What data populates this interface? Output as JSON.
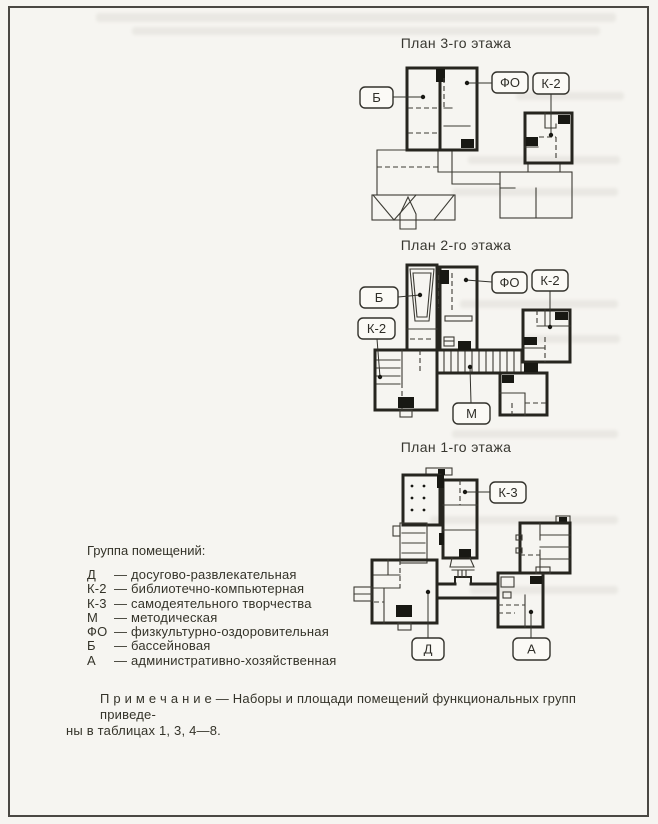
{
  "document": {
    "plans": [
      {
        "title": "План 3-го этажа",
        "callouts": {
          "b": "Б",
          "fo": "ФО",
          "k2": "К-2"
        }
      },
      {
        "title": "План 2-го этажа",
        "callouts": {
          "b": "Б",
          "k2_left": "К-2",
          "fo": "ФО",
          "k2_right": "К-2",
          "m": "М"
        }
      },
      {
        "title": "План 1-го этажа",
        "callouts": {
          "k3": "К-3",
          "d": "Д",
          "a": "А"
        }
      }
    ],
    "legend": {
      "heading": "Группа помещений:",
      "items": [
        {
          "code": "Д",
          "dash": "—",
          "label": "досугово-развлекательная"
        },
        {
          "code": "К-2",
          "dash": "—",
          "label": "библиотечно-компьютерная"
        },
        {
          "code": "К-3",
          "dash": "—",
          "label": "самодеятельного творчества"
        },
        {
          "code": "М",
          "dash": "—",
          "label": "методическая"
        },
        {
          "code": "ФО",
          "dash": "—",
          "label": "физкультурно-оздоровительная"
        },
        {
          "code": "Б",
          "dash": "—",
          "label": "бассейновая"
        },
        {
          "code": "А",
          "dash": "—",
          "label": "административно-хозяйственная"
        }
      ]
    },
    "note": {
      "line1": "П р и м е ч а н и е — Наборы и площади помещений функциональных групп приведе-",
      "line2": "ны в таблицах 1, 3, 4—8."
    },
    "colors": {
      "ink": "#26251f",
      "paper": "#f6f5f1"
    }
  }
}
